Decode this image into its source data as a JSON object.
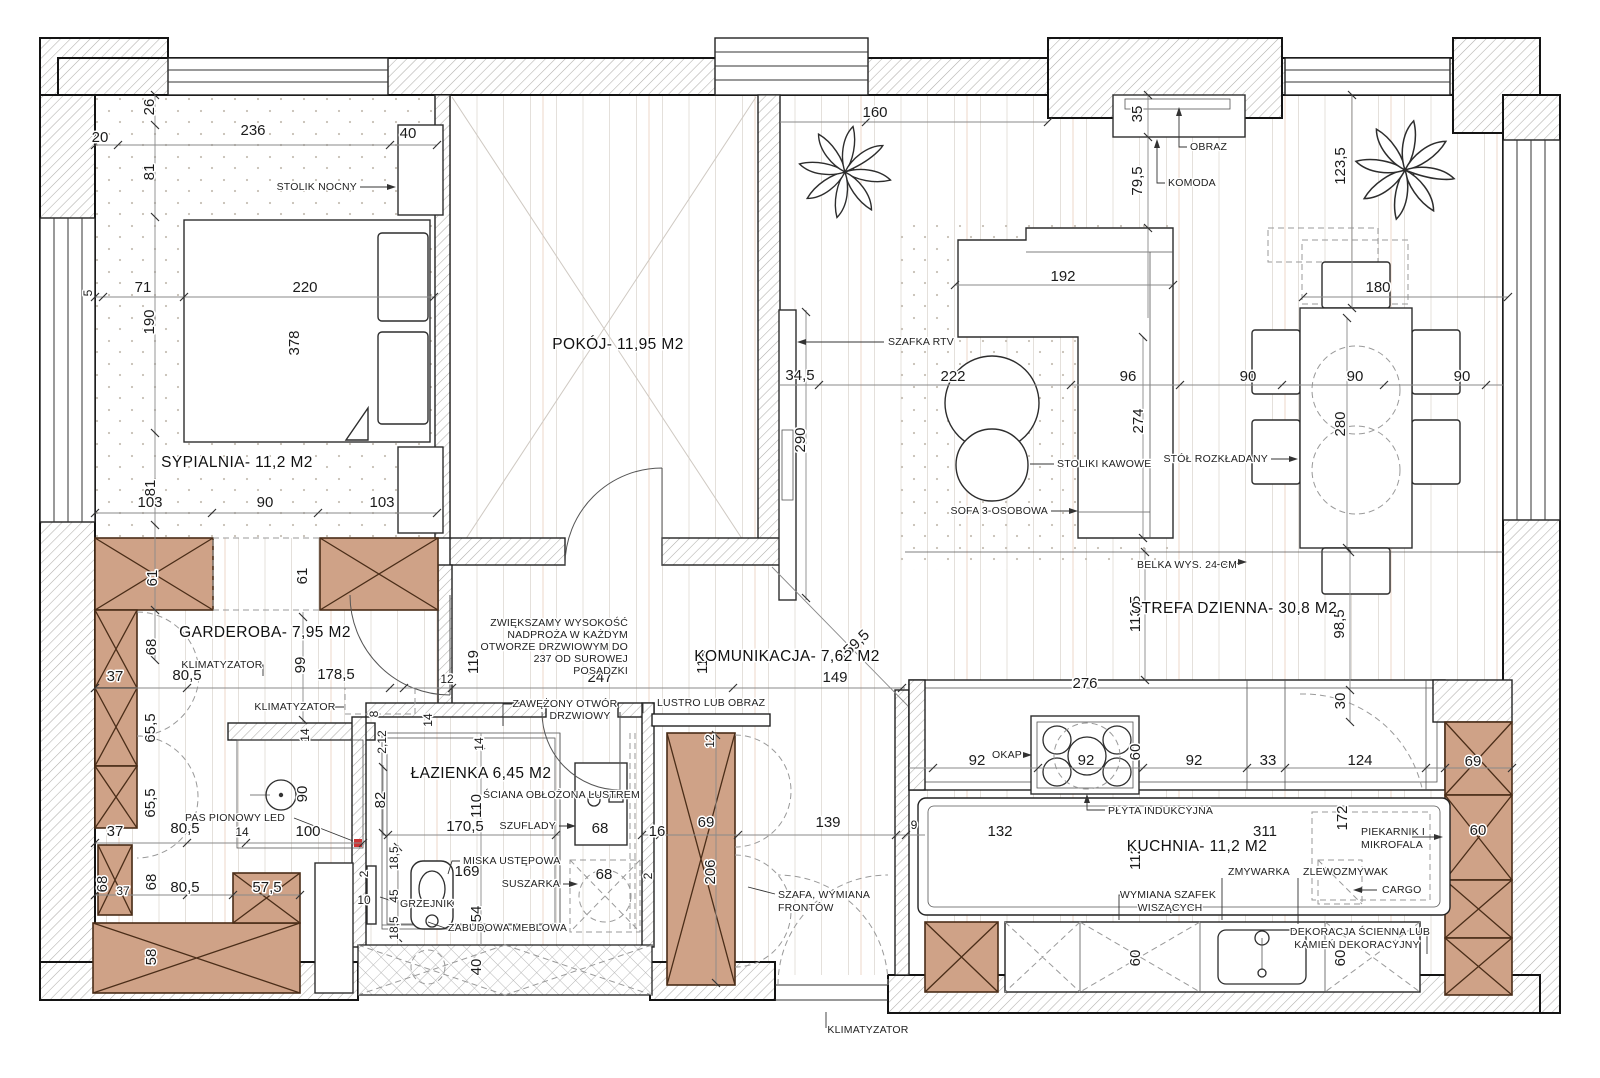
{
  "plan": {
    "colors": {
      "furniture_brown": "#cfa287",
      "led_red": "#cc3333",
      "wall_hatch": "#b0aeab"
    },
    "rooms": {
      "sypialnia": "SYPIALNIA-  11,2 M2",
      "garderoba": "GARDEROBA-  7,95 M2",
      "pokoj": "POKÓJ-  11,95 M2",
      "lazienka": "ŁAZIENKA  6,45 M2",
      "komunikacja": "KOMUNIKACJA-  7,62 M2",
      "strefa": "STREFA DZIENNA-  30,8 M2",
      "kuchnia": "KUCHNIA-  11,2 M2"
    },
    "labels": {
      "stolik_nocny": "STOLIK NOCNY",
      "klimatyzator": "KLIMATYZATOR",
      "pas_led": "PAS PIONOWY LED",
      "grzejnik": "GRZEJNIK",
      "miska": "MISKA USTĘPOWA",
      "zabudowa": "ZABUDOWA MEBLOWA",
      "suszarka": "SUSZARKA",
      "szuflady": "SZUFLADY",
      "sciana_lustro": "ŚCIANA OBŁOŻONA LUSTREM",
      "zawezony1": "ZAWĘŻONY OTWÓR",
      "zawezony2": "DRZWIOWY",
      "lustro": "LUSTRO LUB OBRAZ",
      "szafa1": "SZAFA, WYMIANA",
      "szafa2": "FRONTÓW",
      "szafka_rtv": "SZAFKA RTV",
      "obraz": "OBRAZ",
      "komoda": "KOMODA",
      "stoliki": "STOLIKI KAWOWE",
      "sofa": "SOFA 3-OSOBOWA",
      "stol": "STÓŁ ROZKŁADANY",
      "belka": "BELKA WYS. 24 CM",
      "okap": "OKAP",
      "plyta": "PŁYTA INDUKCYJNA",
      "zmywarka": "ZMYWARKA",
      "zlewozmywak": "ZLEWOZMYWAK",
      "wymiana1": "WYMIANA SZAFEK",
      "wymiana2": "WISZĄCYCH",
      "piekarnik1": "PIEKARNIK I",
      "piekarnik2": "MIKROFALA",
      "cargo": "CARGO",
      "dekoracja1": "DEKORACJA ŚCIENNA LUB",
      "dekoracja2": "KAMIEŃ DEKORACYJNY"
    },
    "note": {
      "l1": "ZWIĘKSZAMY WYSOKOŚĆ",
      "l2": "NADPROŻA W KAŻDYM",
      "l3": "OTWORZE DRZWIOWYM DO",
      "l4": "237 OD SUROWEJ",
      "l5": "POSADZKI"
    },
    "dims": {
      "v2": "2",
      "v2_12": "2,12",
      "v5": "5",
      "v8": "8",
      "v9": "9",
      "v10": "10",
      "v12": "12",
      "v14": "14",
      "v16": "16",
      "v18_5": "18,5",
      "v20": "20",
      "v26": "26",
      "v30": "30",
      "v33": "33",
      "v34_5": "34,5",
      "v35": "35",
      "v37": "37",
      "v40": "40",
      "v45": "45",
      "v54": "54",
      "v57_5": "57,5",
      "v58": "58",
      "v60": "60",
      "v61": "61",
      "v65_5": "65,5",
      "v68": "68",
      "v69": "69",
      "v71": "71",
      "v79_5": "79,5",
      "v80_5": "80,5",
      "v81": "81",
      "v82": "82",
      "v90": "90",
      "v92": "92",
      "v96": "96",
      "v98_5": "98,5",
      "v99": "99",
      "v100": "100",
      "v103": "103",
      "v110": "110",
      "v112": "112",
      "v113_5": "113,5",
      "v119": "119",
      "v123_5": "123,5",
      "v124": "124",
      "v132": "132",
      "v139": "139",
      "v149": "149",
      "v159_5": "159,5",
      "v160": "160",
      "v169": "169",
      "v170_5": "170,5",
      "v172": "172",
      "v178_5": "178,5",
      "v180": "180",
      "v190": "190",
      "v192": "192",
      "v206": "206",
      "v220": "220",
      "v222": "222",
      "v236": "236",
      "v247": "247",
      "v274": "274",
      "v276": "276",
      "v280": "280",
      "v290": "290",
      "v311": "311",
      "v378": "378"
    }
  }
}
